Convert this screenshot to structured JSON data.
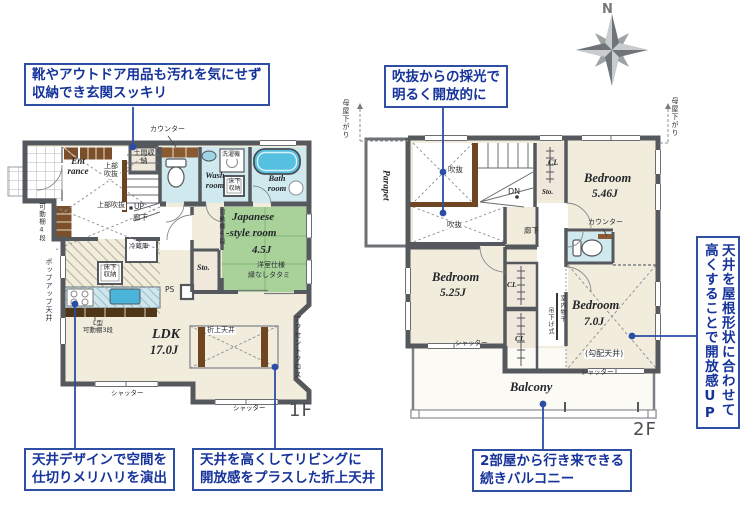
{
  "compass": {
    "north_label": "N"
  },
  "floor1": {
    "label": "1F",
    "entrance": "Ent rance",
    "doma_storage": "土間収納",
    "counter": "カウンター",
    "upper_void_a": "上部吹抜",
    "upper_void_b": "上部吹抜",
    "up": "UP",
    "hallway": "廊下",
    "shelf_4_left": "可動棚4段",
    "wash_room": "Wash room",
    "washer": "洗濯機",
    "underfloor_storage_a": "床下収納",
    "bath_room": "Bath room",
    "japanese_room_line1": "Japanese",
    "japanese_room_line2": "-style room",
    "japanese_room_size": "4.5J",
    "japanese_room_note1": "洋室仕様",
    "japanese_room_note2": "縁なしタタミ",
    "shelf_4_right": "可動棚4段",
    "storage": "Sto.",
    "pipe_space": "PS",
    "refrigerator": "冷蔵庫",
    "underfloor_storage_b": "床下収納",
    "popup_ceiling": "ポップアップ天井",
    "l_shelf_line1": "L型",
    "l_shelf_line2": "可動棚3段",
    "ldk": "LDK",
    "ldk_size": "17.0J",
    "coffered_ceiling": "折上天井",
    "accent_cloth": "アクセントクロス",
    "shutter_a": "シャッター",
    "shutter_b": "シャッター"
  },
  "floor2": {
    "label": "2F",
    "parapet": "Parapet",
    "void_a": "吹抜",
    "void_b": "吹抜",
    "down": "DN",
    "closet_top": "CL",
    "storage": "Sto.",
    "bedroom1": "Bedroom",
    "bedroom1_size": "5.46J",
    "counter": "カウンター",
    "hallway": "廊下",
    "bedroom2": "Bedroom",
    "bedroom2_size": "5.25J",
    "closet_mid": "CL",
    "closet_bottom": "CL",
    "drying_line1": "室内物干",
    "drying_line2": "吊下げ式",
    "bedroom3": "Bedroom",
    "bedroom3_size": "7.0J",
    "sloped_ceiling": "(勾配天井)",
    "shutter_a": "シャッター",
    "shutter_b": "シャッター",
    "balcony": "Balcony",
    "moya_left": "母屋下がり",
    "moya_right": "母屋下がり"
  },
  "callouts": {
    "entrance": {
      "line1": "靴やアウトドア用品も汚れを気にせず",
      "line2": "収納でき玄関スッキリ"
    },
    "void_light": {
      "line1": "吹抜からの採光で",
      "line2": "明るく開放的に"
    },
    "ceiling_design": {
      "line1": "天井デザインで空間を",
      "line2": "仕切りメリハリを演出"
    },
    "coffered": {
      "line1": "天井を高くしてリビングに",
      "line2": "開放感をプラスした折上天井"
    },
    "balcony_link": {
      "line1": "2部屋から行き来できる",
      "line2": "続きバルコニー"
    },
    "sloped_ceiling": {
      "line1": "天井を屋根形状に合わせて",
      "line2": "高くすることで開放感UP"
    }
  }
}
